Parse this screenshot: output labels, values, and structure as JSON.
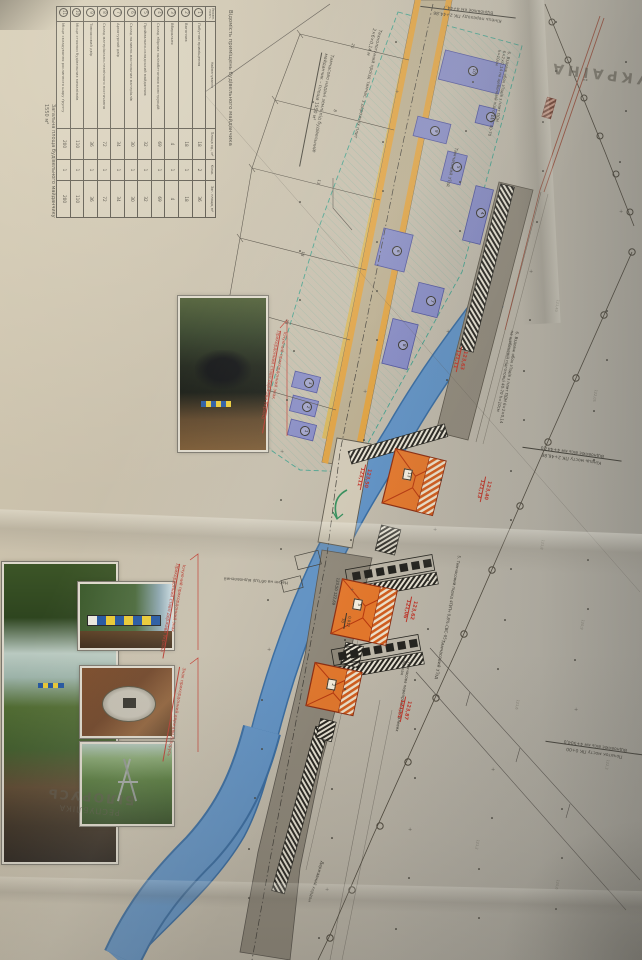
{
  "countries": {
    "top": "УКРАЇНА",
    "bottom_line1": "РЕСПУБЛІКА",
    "bottom_line2": "БІЛОРУСЬ"
  },
  "table": {
    "title": "Відомість приміщень будівельного майданчика",
    "headers": [
      "Умовн. позн.",
      "Найменування",
      "Площа од., м²",
      "Кільк.",
      "Заг. площа, м²"
    ],
    "rows": [
      [
        "1",
        "Побутові приміщення",
        "18",
        "2",
        "36"
      ],
      [
        "2",
        "Вагончик",
        "18",
        "1",
        "18"
      ],
      [
        "3",
        "Вбиральня",
        "4",
        "1",
        "4"
      ],
      [
        "4",
        "Склад збірних залізобетонних конструкцій",
        "69",
        "1",
        "69"
      ],
      [
        "5",
        "Приймально-складський майданчик",
        "32",
        "1",
        "32"
      ],
      [
        "6",
        "Склад паливно-мастильних матеріалів",
        "30",
        "1",
        "30"
      ],
      [
        "7",
        "Арматурний двір",
        "34",
        "1",
        "34"
      ],
      [
        "8",
        "Склад матеріально-технічного постачання",
        "72",
        "1",
        "72"
      ],
      [
        "9",
        "Тимчасовий двір",
        "36",
        "1",
        "36"
      ],
      [
        "10",
        "Місце стоянки будівельних механізмів",
        "110",
        "1",
        "110"
      ],
      [
        "11",
        "Місце складування рослинного шару ґрунту",
        "200",
        "1",
        "200"
      ]
    ],
    "footer": "Загальна площа будівельного майданчику 1550 м²"
  },
  "notes": {
    "land_note": "Тимчасово надані землі під будівельний майданчик – площа 1550 м²",
    "tech_road": "Технологічний проїзд тимчас. з дорожніх плит 2×6×0,14 м",
    "slab_note": "6. Вздовж обох з'їздів з плит ПДН 6×2×0,14 на щебеневій підготовці 40-70 h=10см",
    "slab_note2": "6. Вздовж обох з'їздів з плит ПДН 6×2×0,14 на щебеневій підготовці 40-70 h=10см",
    "temp_exit": "Тимчасовий з'їзд",
    "temp_exit2": "Тимчасовий з'їзд",
    "temp_approach": "5. Тимчасовий підхід 4П/Пч 0,8%-СВС-05",
    "temp_ferry": "Тимчасова переправа на палевих балках",
    "state_border": "Державний кордон",
    "fill_note": "Насип на об'їзді відновлений",
    "end_crossing_1": "Кінець переходу ПК 2+44,86",
    "end_crossing_2": "Відновлює км 4+44,7",
    "end_bridge_1": "Кінець мосту ПК 2+46,86",
    "end_bridge_2": "Відновлює вісь км 4+447,0",
    "start_bridge_1": "Початок мосту ПК 0+00",
    "start_bridge_2": "Відновлює вісь км 4+504,0"
  },
  "captions": {
    "existing_sign_title": "Існуючий прикордонний знак",
    "existing_sign_sub": "Прикордонний стовп держави Україна",
    "existing_sign_title2": "Існуючий прикордонний знак",
    "existing_sign_sub2": "Прикордонний стовп держави Україна",
    "by_sign": "Знак прикордонний держави Білорусь"
  },
  "elevations": [
    {
      "top": "123,50",
      "bottom": "123,11"
    },
    {
      "top": "123,63",
      "bottom": "121,11"
    },
    {
      "top": "123,40",
      "bottom": "121,13"
    },
    {
      "top": "123,62",
      "bottom": "121,06"
    },
    {
      "top": "123,87",
      "bottom": "121,51"
    }
  ],
  "river_marks": {
    "levels": "123,50  122,69",
    "slope": "0,012",
    "dist": "70"
  },
  "dims": [
    "20",
    "8",
    "13",
    "18",
    "23"
  ],
  "spot_elevations": [
    "121,40",
    "122,05",
    "121,8",
    "120,9",
    "121,6",
    "122,3",
    "121,2",
    "120,6"
  ],
  "building_numbers": [
    "1",
    "2",
    "3",
    "4",
    "5",
    "6",
    "7",
    "8",
    "9",
    "10",
    "11"
  ],
  "pavilion_numbers": [
    "13",
    "5",
    "2"
  ],
  "colors": {
    "paper": "#c4bcaa",
    "river": "#5d8fc2",
    "road_new": "#b7aa8c",
    "road_shoulder": "#dd9e3c",
    "road_old": "#8c8577",
    "building": "#8186c2",
    "pavilion": "#e1762b",
    "red_label": "#bf3428",
    "teal_zone": "#3f9d8a",
    "ink": "#4a453c"
  }
}
